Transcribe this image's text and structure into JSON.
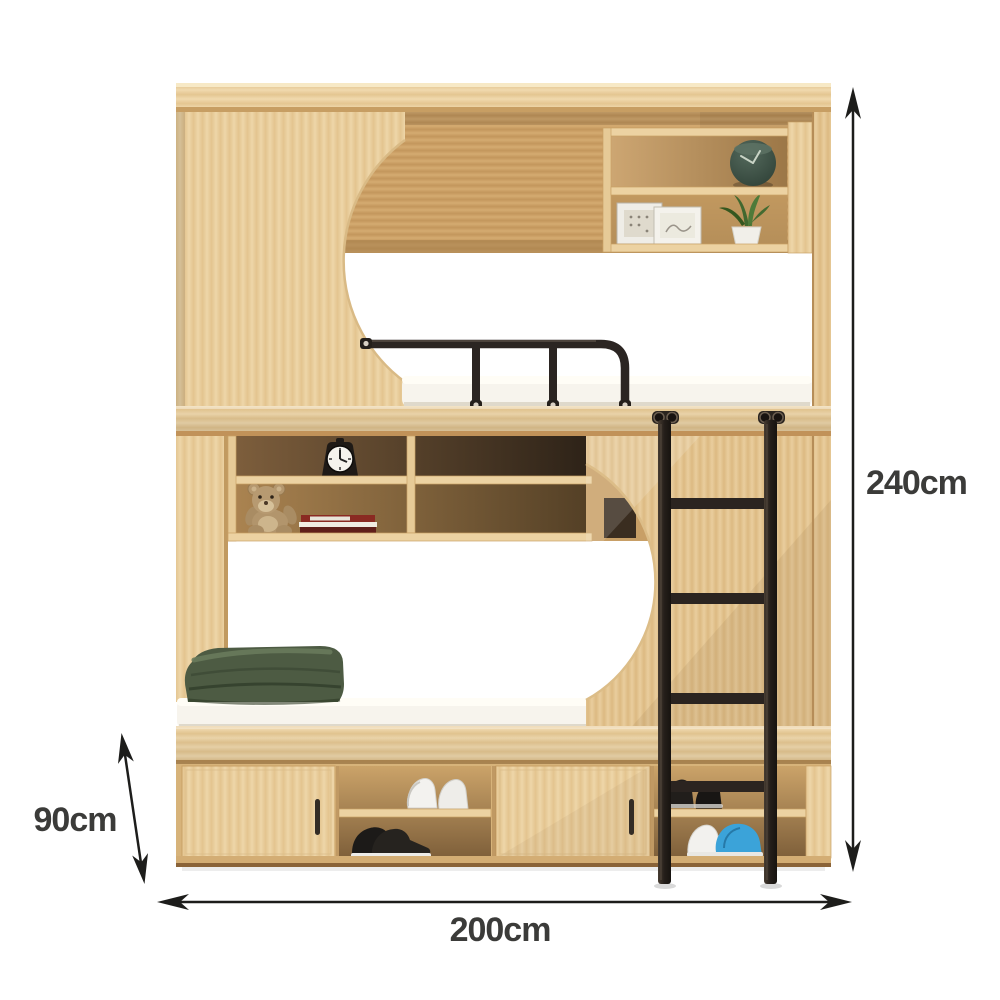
{
  "page": {
    "background": "#ffffff",
    "type": "product-dimension-image"
  },
  "product": {
    "name": "Wooden bunk bed with storage cabinets, wall shelves and metal ladder",
    "annotations": {
      "total_height": "240cm",
      "total_width": "200cm",
      "lower_section_height": "90cm"
    },
    "colors": {
      "wood_light": "#edd4a6",
      "wood_mid": "#d9b37c",
      "wood_dark_interior": "#8a6a42",
      "metal_black": "#2b2420",
      "mattress_white": "#f7f4ed",
      "blanket_green": "#4e5c44",
      "accent_blue_shoe": "#3ba3d9",
      "dimension_text": "#3b3b39",
      "dimension_line": "#1d1d1b"
    },
    "decor": {
      "upper_shelf": [
        "round green clock",
        "two photo frames",
        "potted succulent"
      ],
      "middle_shelf": [
        "black alarm clock",
        "teddy bear",
        "stack of books"
      ],
      "lower_bed": [
        "folded green blanket"
      ],
      "cabinet_shoes": [
        "white sneakers",
        "black shoes",
        "black sneakers",
        "white and blue shoes"
      ]
    }
  }
}
